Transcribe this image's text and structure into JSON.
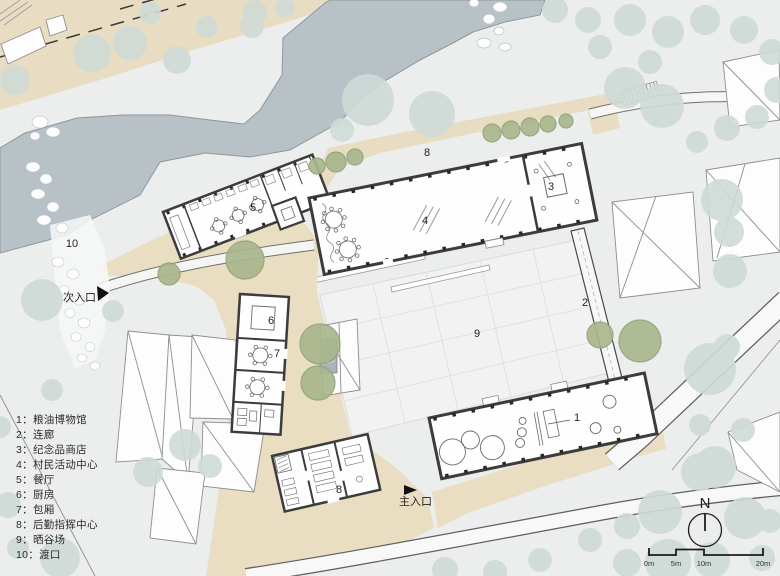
{
  "legend": {
    "items": [
      "1：粮油博物馆",
      "2：连廊",
      "3：纪念品商店",
      "4：村民活动中心",
      "5：餐厅",
      "6：厨房",
      "7：包厢",
      "8：后勤指挥中心",
      "9：晒谷场",
      "10：渡口"
    ]
  },
  "plan_labels": {
    "museum": "1",
    "corridor": "2",
    "souvenir_shop": "3",
    "activity_center": "4",
    "restaurant": "5",
    "kitchen": "6",
    "private_rooms": "7",
    "path": "8",
    "logistics_center": "8",
    "drying_field": "9",
    "ferry": "10"
  },
  "entrances": {
    "secondary": "次入口",
    "main": "主入口"
  },
  "compass": {
    "north": "N"
  },
  "scale_bar": {
    "ticks": [
      "0m",
      "5m",
      "10m",
      "20m"
    ]
  },
  "colors": {
    "river": "#b7c1c6",
    "tree_pale": "#cfdbd7",
    "tree_olive": "#a9b78d",
    "plaza_beige": "#e9ddc2",
    "wall": "#3c3c3c",
    "field": "#f1f2f1",
    "background": "#eceeed"
  }
}
